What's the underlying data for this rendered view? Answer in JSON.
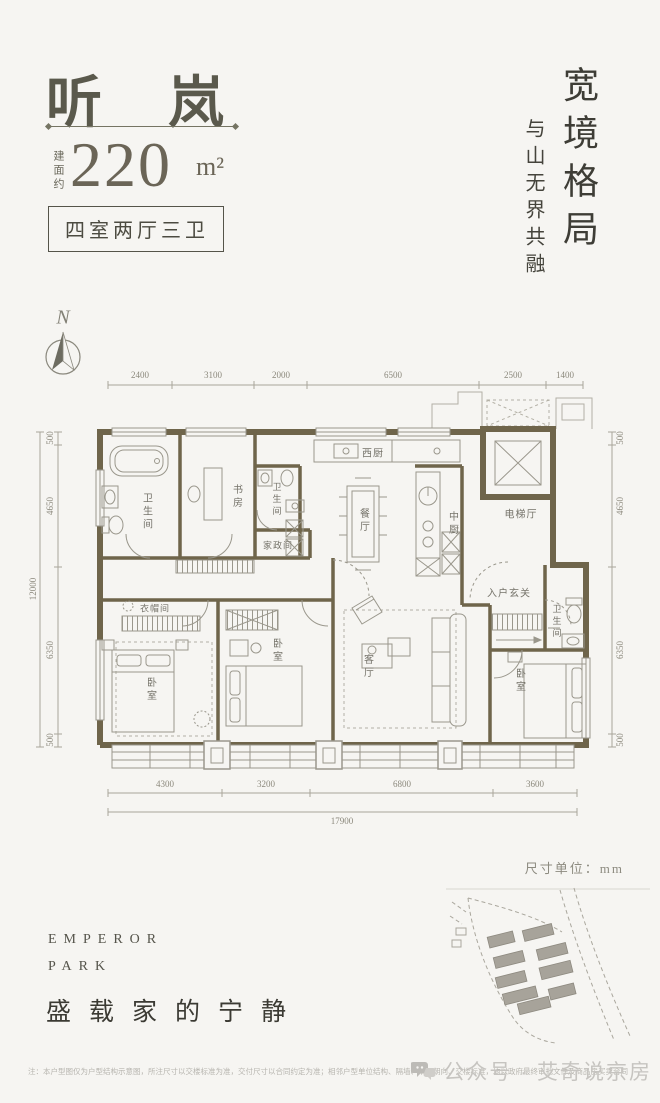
{
  "header": {
    "title": "听 岚",
    "area_prefix": "建面约",
    "area_number": "220",
    "area_unit": "m²",
    "layout_tag": "四室两厅三卫"
  },
  "tagline": {
    "main": "宽境格局",
    "sub": "与山无界共融"
  },
  "compass": {
    "north_label": "N"
  },
  "plan": {
    "dims": {
      "top": [
        "2400",
        "3100",
        "2000",
        "6500",
        "2500",
        "1400"
      ],
      "bottom": [
        "4300",
        "3200",
        "6800",
        "3600"
      ],
      "bottom_total": "17900",
      "left": [
        "500",
        "4650",
        "6350",
        "500"
      ],
      "left_total": "12000",
      "right": [
        "500",
        "4650",
        "6350",
        "500"
      ]
    },
    "rooms": {
      "bath_main": "卫生间",
      "study": "书房",
      "bath_small": "卫生间",
      "housekeeping": "家政间",
      "west_kitchen": "西厨",
      "dining": "餐厅",
      "chinese_kitchen": "中厨",
      "elevator_hall": "电梯厅",
      "foyer": "入户玄关",
      "bath_right": "卫生间",
      "cloakroom": "衣帽间",
      "bedroom_master": "卧室",
      "bedroom_mid": "卧室",
      "living": "客厅",
      "bedroom_right": "卧室"
    }
  },
  "sitemap": {
    "unit_note": "尺寸单位：mm"
  },
  "brand": {
    "line1": "EMPEROR",
    "line2": "PARK",
    "slogan": "盛载家的宁静"
  },
  "footer": {
    "disclaimer": "注：本户型图仅为户型结构示意图，所注尺寸以交楼标准为准，交付尺寸以合同约定为准；相邻户型单位结构、隔墙、单元朝向、交楼标准，均以政府最终审批文件及商品房买卖合同为准。",
    "watermark": "公众号 · 艾奇说京房"
  }
}
